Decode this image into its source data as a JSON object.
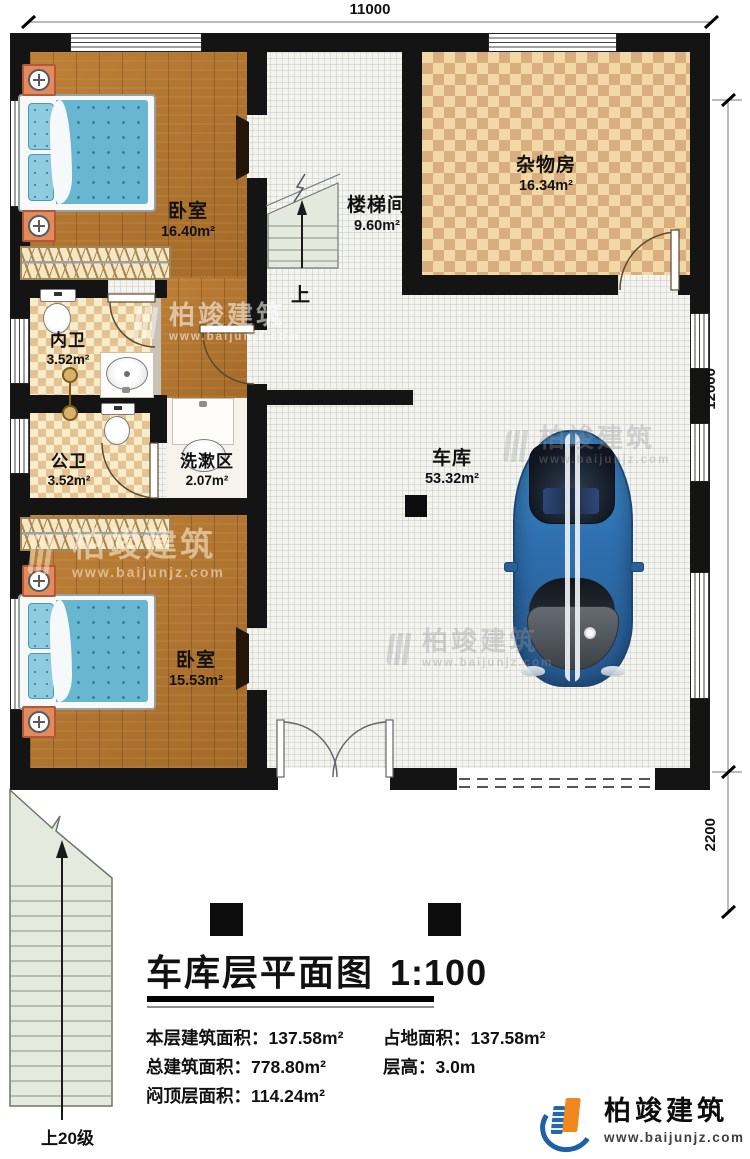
{
  "plan": {
    "dimensions": {
      "top": "11000",
      "right_main": "12000",
      "right_lower": "2200"
    },
    "rooms": {
      "bedroom1": {
        "name": "卧室",
        "area": "16.40m²"
      },
      "stairwell": {
        "name": "楼梯间",
        "area": "9.60m²"
      },
      "storage": {
        "name": "杂物房",
        "area": "16.34m²"
      },
      "inner_bath": {
        "name": "内卫",
        "area": "3.52m²"
      },
      "public_bath": {
        "name": "公卫",
        "area": "3.52m²"
      },
      "wash_area": {
        "name": "洗漱区",
        "area": "2.07m²"
      },
      "garage": {
        "name": "车库",
        "area": "53.32m²"
      },
      "bedroom2": {
        "name": "卧室",
        "area": "15.53m²"
      }
    },
    "stair_up_label": "上",
    "exterior_stair_label": "上20级"
  },
  "title": {
    "text": "车库层平面图",
    "scale": "1:100"
  },
  "stats": {
    "left": [
      {
        "label": "本层建筑面积：",
        "value": "137.58m²"
      },
      {
        "label": "总建筑面积：",
        "value": "778.80m²"
      },
      {
        "label": "闷顶层面积：",
        "value": "114.24m²"
      }
    ],
    "right": [
      {
        "label": "占地面积：",
        "value": "137.58m²"
      },
      {
        "label": "层高：",
        "value": "3.0m"
      }
    ]
  },
  "logo": {
    "name": "柏竣建筑",
    "url": "www.baijunjz.com"
  },
  "watermark": {
    "name": "柏竣建筑",
    "url": "www.baijunjz.com"
  },
  "colors": {
    "accent_blue": "#1f5fa8",
    "accent_orange": "#f0881e",
    "wall": "#141414",
    "wood": "#b1742e"
  }
}
